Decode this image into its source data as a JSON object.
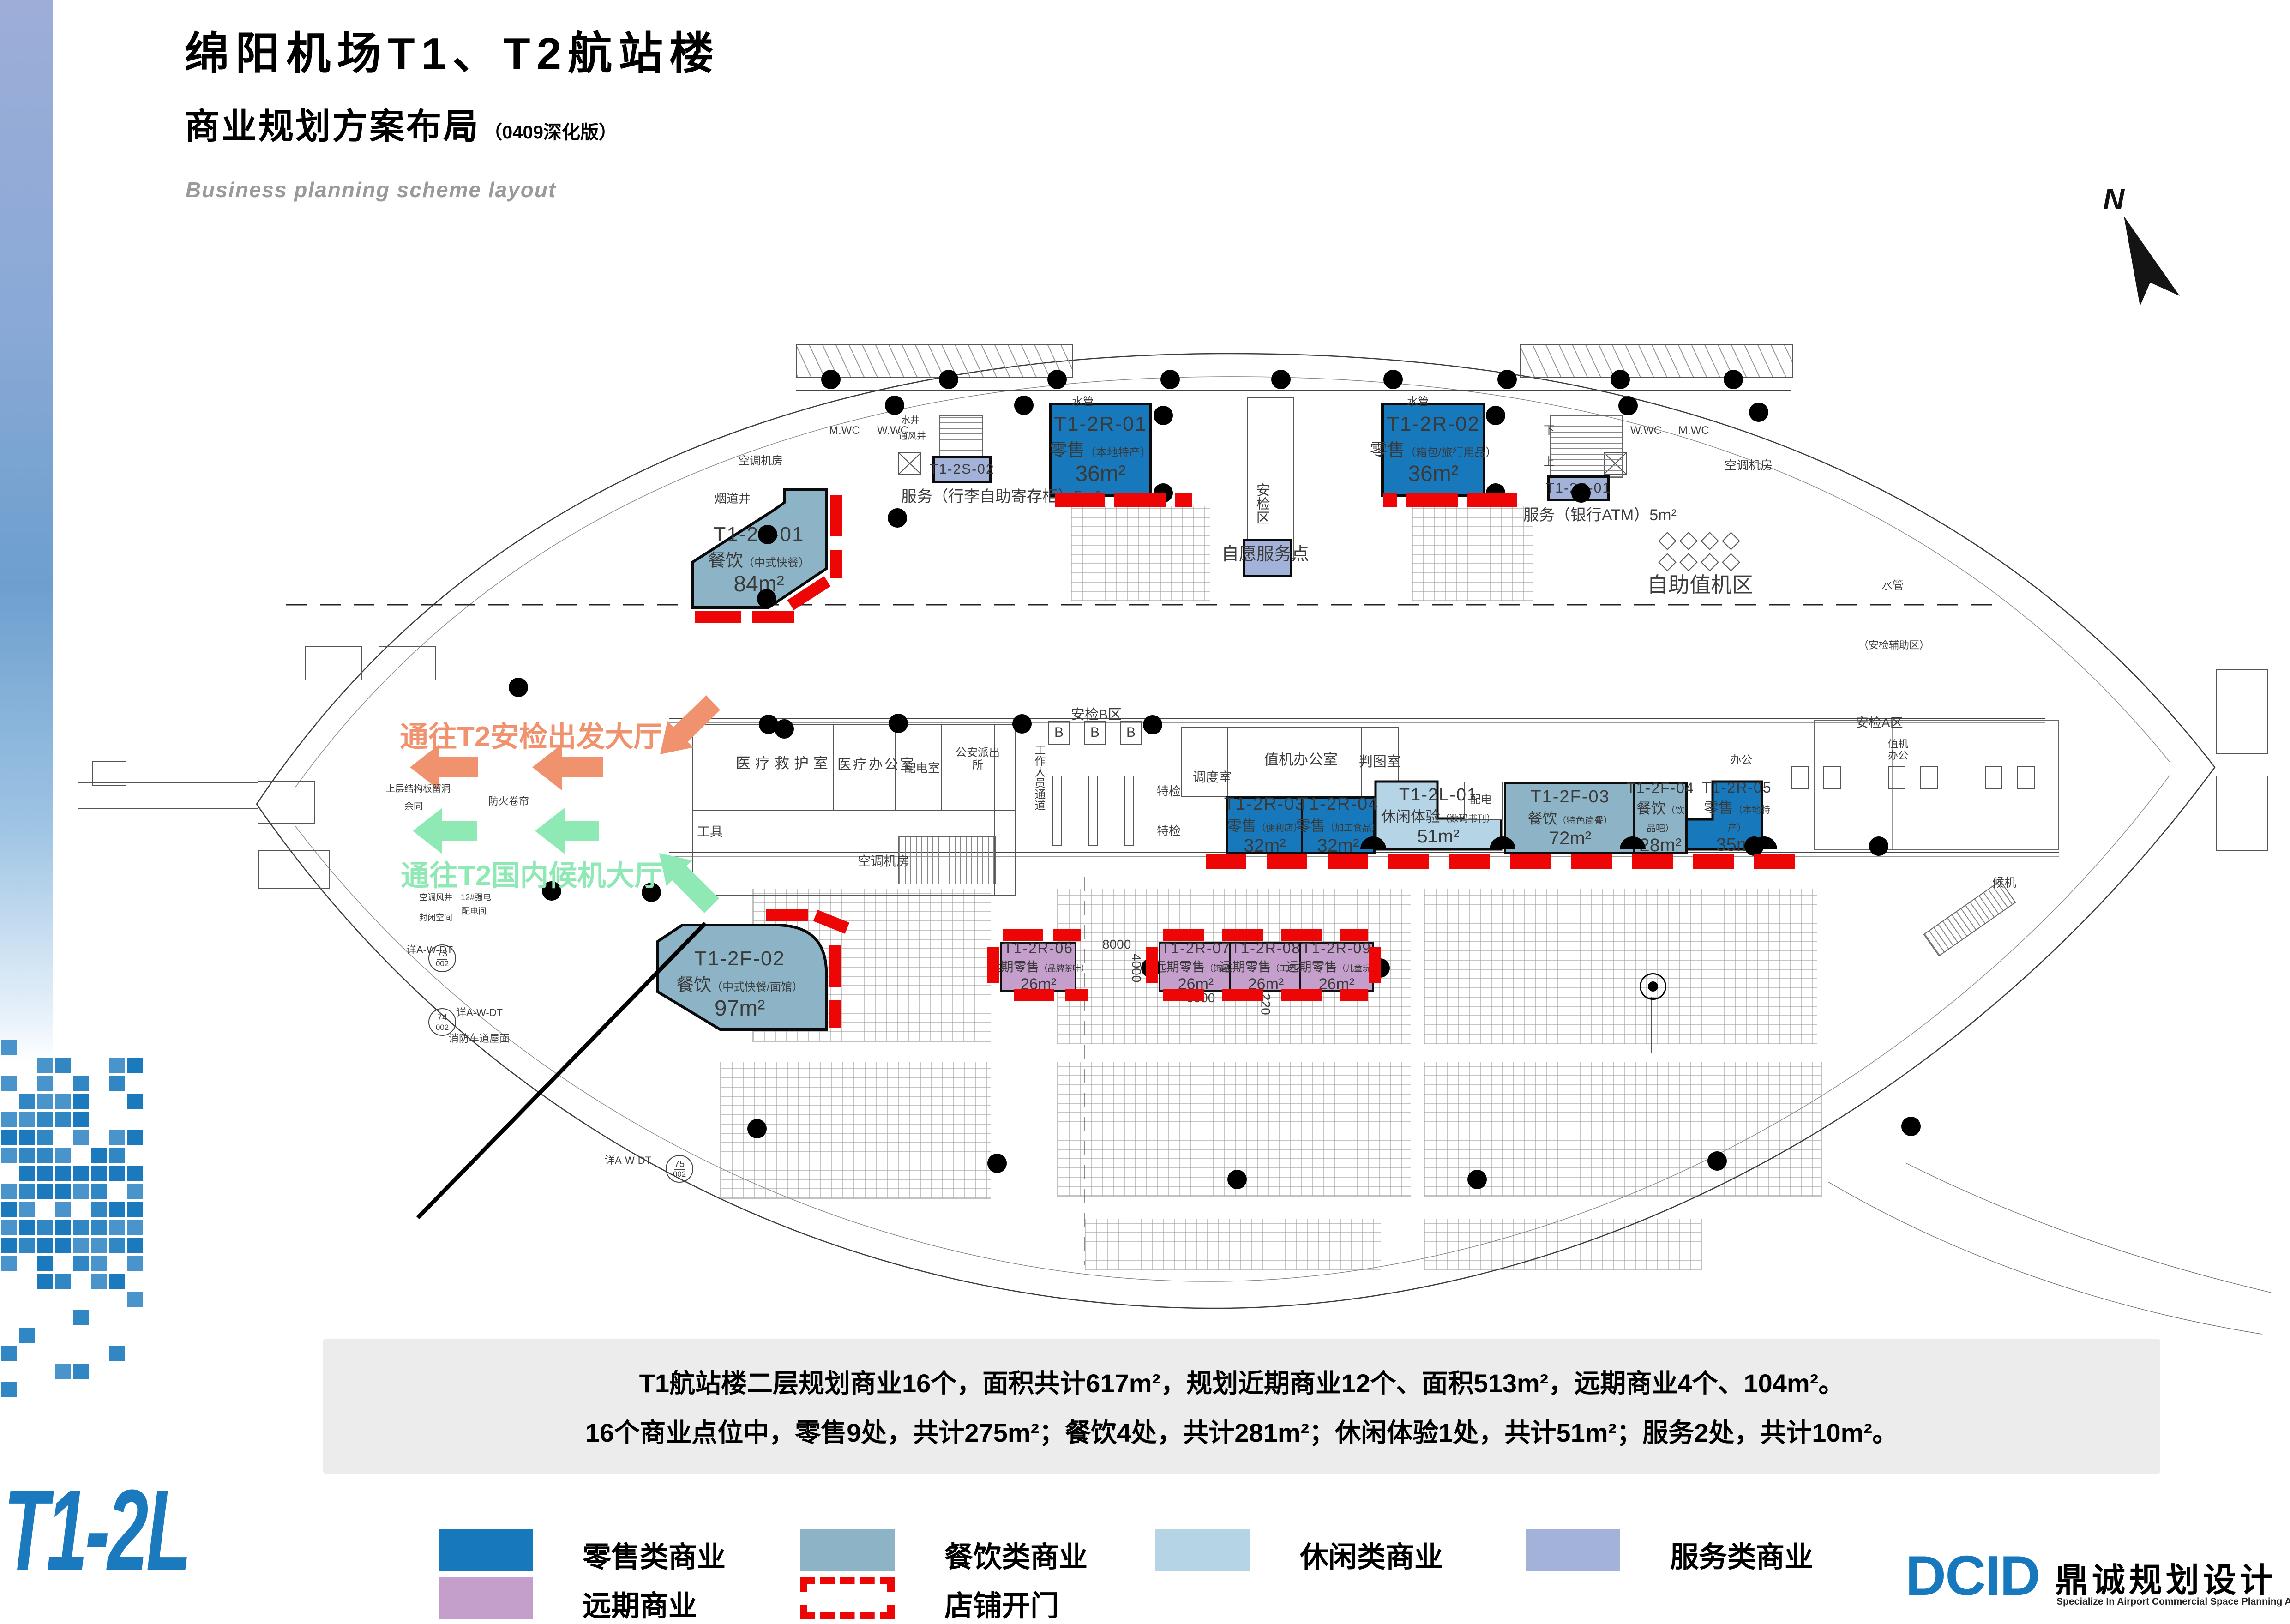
{
  "header": {
    "title": "绵阳机场T1、T2航站楼",
    "subtitle": "商业规划方案布局",
    "subtitle_note": "（0409深化版）",
    "subtitle_en": "Business planning scheme layout"
  },
  "north_label": "N",
  "floor_code": "T1-2L",
  "annotations": {
    "to_t2_security": "通往T2安检出发大厅",
    "to_t2_domestic": "通往T2国内候机大厅"
  },
  "summary": {
    "line1": "T1航站楼二层规划商业16个，面积共计617m²，规划近期商业12个、面积513m²，远期商业4个、104m²。",
    "line2": "16个商业点位中，零售9处，共计275m²；餐饮4处，共计281m²；休闲体验1处，共计51m²；服务2处，共计10m²。"
  },
  "legend": {
    "items": [
      {
        "label": "零售类商业",
        "color": "#1878BC",
        "style": "solid"
      },
      {
        "label": "餐饮类商业",
        "color": "#8CB4C6",
        "style": "solid"
      },
      {
        "label": "休闲类商业",
        "color": "#B5D4E5",
        "style": "solid"
      },
      {
        "label": "服务类商业",
        "color": "#A3B2D8",
        "style": "solid"
      },
      {
        "label": "远期商业",
        "color": "#C49FCB",
        "style": "solid"
      },
      {
        "label": "店铺开门",
        "color": "#EE0505",
        "style": "dashed"
      }
    ]
  },
  "logo": {
    "mark": "DCID",
    "name": "鼎诚规划设计",
    "tagline": "Specialize In Airport Commercial Space Planning And Designing"
  },
  "shops": {
    "r01": {
      "id": "T1-2R-01",
      "cat": "零售",
      "sub": "（本地特产）",
      "area": "36m²"
    },
    "r02": {
      "id": "T1-2R-02",
      "cat": "零售",
      "sub": "（箱包/旅行用品）",
      "area": "36m²"
    },
    "r03": {
      "id": "T1-2R-03",
      "cat": "零售",
      "sub": "（便利店）",
      "area": "32m²"
    },
    "r04": {
      "id": "T1-2R-04",
      "cat": "零售",
      "sub": "（加工食品）",
      "area": "32m²"
    },
    "r05": {
      "id": "T1-2R-05",
      "cat": "零售",
      "sub": "（本地特产）",
      "area": "35m²"
    },
    "r06": {
      "id": "T1-2R-06",
      "cat": "远期零售",
      "sub": "（品牌茶叶）",
      "area": "26m²"
    },
    "r07": {
      "id": "T1-2R-07",
      "cat": "远期零售",
      "sub": "（饰品）",
      "area": "26m²"
    },
    "r08": {
      "id": "T1-2R-08",
      "cat": "远期零售",
      "sub": "（工艺品）",
      "area": "26m²"
    },
    "r09": {
      "id": "T1-2R-09",
      "cat": "远期零售",
      "sub": "（儿童玩具）",
      "area": "26m²"
    },
    "f01": {
      "id": "T1-2F-01",
      "cat": "餐饮",
      "sub": "（中式快餐）",
      "area": "84m²"
    },
    "f02": {
      "id": "T1-2F-02",
      "cat": "餐饮",
      "sub": "（中式快餐/面馆）",
      "area": "97m²"
    },
    "f03": {
      "id": "T1-2F-03",
      "cat": "餐饮",
      "sub": "（特色简餐）",
      "area": "72m²"
    },
    "f04": {
      "id": "T1-2F-04",
      "cat": "餐饮",
      "sub": "（饮品吧）",
      "area": "28m²"
    },
    "l01": {
      "id": "T1-2L-01",
      "cat": "休闲体验",
      "sub": "（数码书刊）",
      "area": "51m²"
    },
    "s01": {
      "id": "T1-2S-01",
      "label": "服务（银行ATM）5m²"
    },
    "s02": {
      "id": "T1-2S-02",
      "label": "服务（行李自助寄存柜）5m²"
    }
  },
  "plan_labels": {
    "anjianqu": "安检区",
    "mwc": "M.WC",
    "wwc": "W.WC",
    "shuijing": "水井",
    "tongfengjing": "通风井",
    "shuiguan": "水管",
    "yandaojing": "烟道井",
    "kongtiaojifang": "空调机房",
    "zizhufuwudian": "自愿服务点",
    "zizhuzhijiqu": "自助值机区",
    "anjianB": "安检B区",
    "gongzuotongdao": "工作人员通道",
    "tejian": "特检",
    "diaodushi": "调度室",
    "zhijibangongshi": "值机办公室",
    "pantushi": "判图室",
    "peidian": "配电",
    "bangong": "办公",
    "zhijibangong": "值机办公",
    "anjianA": "安检A区",
    "anjianfuzhu": "（安检辅助区）",
    "houji": "候机",
    "yiliaojiuhushi": "医疗救护室",
    "yiliaobangongshi": "医疗办公室",
    "peidianshi": "配电室",
    "gongan": "公安派出所",
    "gongju": "工具",
    "dim8000": "8000",
    "dim4000": "4000",
    "dim6000": "6000",
    "dim220": "220",
    "note": "详A-W-DT",
    "xiaofang": "消防车道屋面",
    "n73": "73",
    "n74": "74",
    "n75": "75",
    "n002": "002",
    "shang": "上",
    "xia": "下",
    "b": "B",
    "shangceng": "上层结构板留洞",
    "yutong": "余同",
    "fanghuojuanlian": "防火卷帘",
    "kongtiaofengjing": "空调风井",
    "qiangdian": "12#强电",
    "peidianjian": "配电间",
    "fengbikongjian": "封闭空间"
  }
}
